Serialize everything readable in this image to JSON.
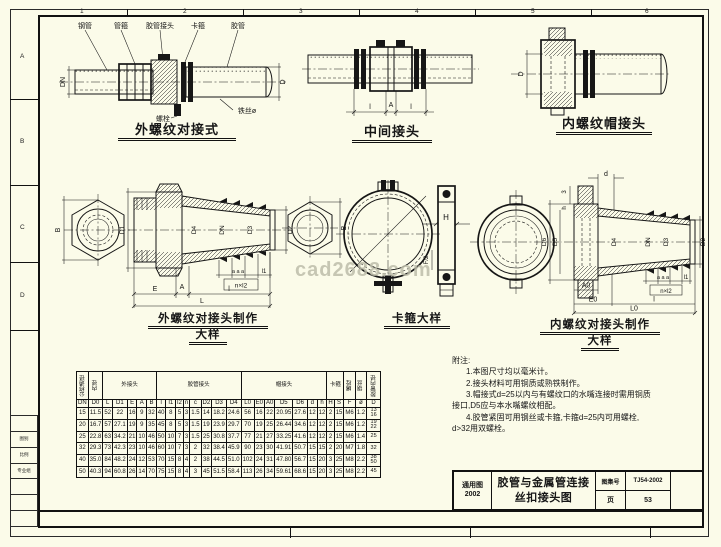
{
  "sheet": {
    "watermark": "cad2688.com"
  },
  "zones": {
    "top": [
      "1",
      "2",
      "3",
      "4",
      "5",
      "6"
    ],
    "left": [
      "A",
      "B",
      "C",
      "D"
    ]
  },
  "d1": {
    "caption": "外螺纹对接式",
    "parts": [
      "钢管",
      "管箍",
      "胶管接头",
      "卡箍",
      "胶管",
      "螺栓",
      "铁丝ø"
    ],
    "dims": [
      "DN",
      "D"
    ]
  },
  "d2": {
    "caption": "中间接头",
    "dims": [
      "l",
      "A",
      "l"
    ]
  },
  "d3": {
    "caption": "内螺纹帽接头",
    "dims": [
      "D"
    ]
  },
  "d4": {
    "caption": "外螺纹对接头制作",
    "caption2": "大样",
    "dims": {
      "B": "B",
      "D1": "D1",
      "D4": "D4",
      "DN": "DN",
      "D3": "D3",
      "D2": "D2",
      "E": "E",
      "A": "A",
      "l": "l",
      "L": "L",
      "aaa": "a a a",
      "l1": "l1",
      "nxl2": "n×l2"
    }
  },
  "d5": {
    "caption": "卡箍大样",
    "dims": {
      "B": "B",
      "H": "H",
      "F2": "F/2"
    }
  },
  "d6": {
    "caption": "内螺纹对接头制作",
    "caption2": "大样",
    "dims": {
      "d": "d",
      "three": "3",
      "h": "h",
      "D6": "D6",
      "D5": "D5",
      "D4": "D4",
      "DN": "DN",
      "D3": "D3",
      "D2": "D2",
      "A0": "A0",
      "E0": "E0",
      "l": "l",
      "L0": "L0",
      "aaa": "a a a",
      "l1": "l1",
      "nxl2": "n×l2"
    }
  },
  "table": {
    "groups": [
      {
        "label": "公称通径",
        "span": 1,
        "v": true
      },
      {
        "label": "内径",
        "span": 1,
        "v": true
      },
      {
        "label": "外接头",
        "span": 5
      },
      {
        "label": "胶管接头",
        "span": 8
      },
      {
        "label": "帽接头",
        "span": 7
      },
      {
        "label": "卡箍",
        "span": 2
      },
      {
        "label": "螺栓",
        "span": 1,
        "v": true
      },
      {
        "label": "钢丝",
        "span": 1,
        "v": true
      },
      {
        "label": "胶管内径",
        "span": 1,
        "v": true
      }
    ],
    "cols": [
      "DN",
      "D0",
      "L",
      "D1",
      "E",
      "A",
      "B",
      "l",
      "l1",
      "l2",
      "n",
      "c",
      "D2",
      "D3",
      "D4",
      "L0",
      "E0",
      "A0",
      "D5",
      "D6",
      "d",
      "h",
      "H",
      "S",
      "F",
      "ø",
      "D"
    ],
    "rows": [
      [
        "15",
        "11.5",
        "52",
        "22",
        "16",
        "9",
        "32",
        "40",
        "8",
        "5",
        "3",
        "1.5",
        "14",
        "18.2",
        "24.6",
        "56",
        "16",
        "22",
        "20.95",
        "27.6",
        "12",
        "12",
        "2",
        "15",
        "M6",
        "1.2",
        "13 16"
      ],
      [
        "20",
        "16.7",
        "57",
        "27.1",
        "19",
        "9",
        "35",
        "45",
        "8",
        "5",
        "3",
        "1.5",
        "19",
        "23.9",
        "29.7",
        "70",
        "19",
        "25",
        "26.44",
        "34.6",
        "12",
        "12",
        "2",
        "15",
        "M6",
        "1.2",
        "19 22"
      ],
      [
        "25",
        "22.8",
        "63",
        "34.2",
        "21",
        "10",
        "46",
        "50",
        "10",
        "7",
        "3",
        "1.5",
        "25",
        "30.8",
        "37.7",
        "77",
        "21",
        "27",
        "33.25",
        "41.6",
        "12",
        "12",
        "2",
        "15",
        "M6",
        "1.4",
        "25"
      ],
      [
        "32",
        "29.3",
        "73",
        "42.3",
        "23",
        "10",
        "46",
        "60",
        "10",
        "7",
        "3",
        "2",
        "32",
        "38.4",
        "45.9",
        "90",
        "23",
        "30",
        "41.91",
        "50.7",
        "15",
        "15",
        "2",
        "20",
        "M7",
        "1.8",
        "32"
      ],
      [
        "40",
        "35.0",
        "84",
        "48.2",
        "24",
        "12",
        "53",
        "70",
        "15",
        "8",
        "4",
        "2",
        "38",
        "44.5",
        "51.0",
        "102",
        "24",
        "31",
        "47.80",
        "56.7",
        "15",
        "20",
        "3",
        "25",
        "M8",
        "2.2",
        "38 50"
      ],
      [
        "50",
        "40.3",
        "94",
        "60.8",
        "26",
        "14",
        "70",
        "75",
        "15",
        "8",
        "4",
        "3",
        "45",
        "51.5",
        "58.4",
        "113",
        "26",
        "34",
        "59.61",
        "68.6",
        "15",
        "20",
        "3",
        "25",
        "M8",
        "2.2",
        "45"
      ]
    ]
  },
  "notes": {
    "title": "附注:",
    "lines": [
      "1.本图尺寸均以毫米计。",
      "2.接头材料可用铜质或熟铁制作。",
      "3.帽接式d=25以内与有螺纹口的水嘴连接时需用铜质",
      "接口,D5应与本水嘴螺纹相配。",
      "4.胶管紧固可用钢丝或卡箍,卡箍d=25内可用螺栓,",
      "d>32用双螺栓。"
    ]
  },
  "title_block": {
    "series": "通用图",
    "year": "2002",
    "title1": "胶管与金属管连接",
    "title2": "丝扣接头图",
    "atlas_label": "图集号",
    "atlas_no": "TJ54-2002",
    "page_label": "页",
    "page_no": "53"
  },
  "margin": {
    "rows": [
      "",
      "图别",
      "比例",
      "专业组",
      "",
      "",
      ""
    ]
  }
}
